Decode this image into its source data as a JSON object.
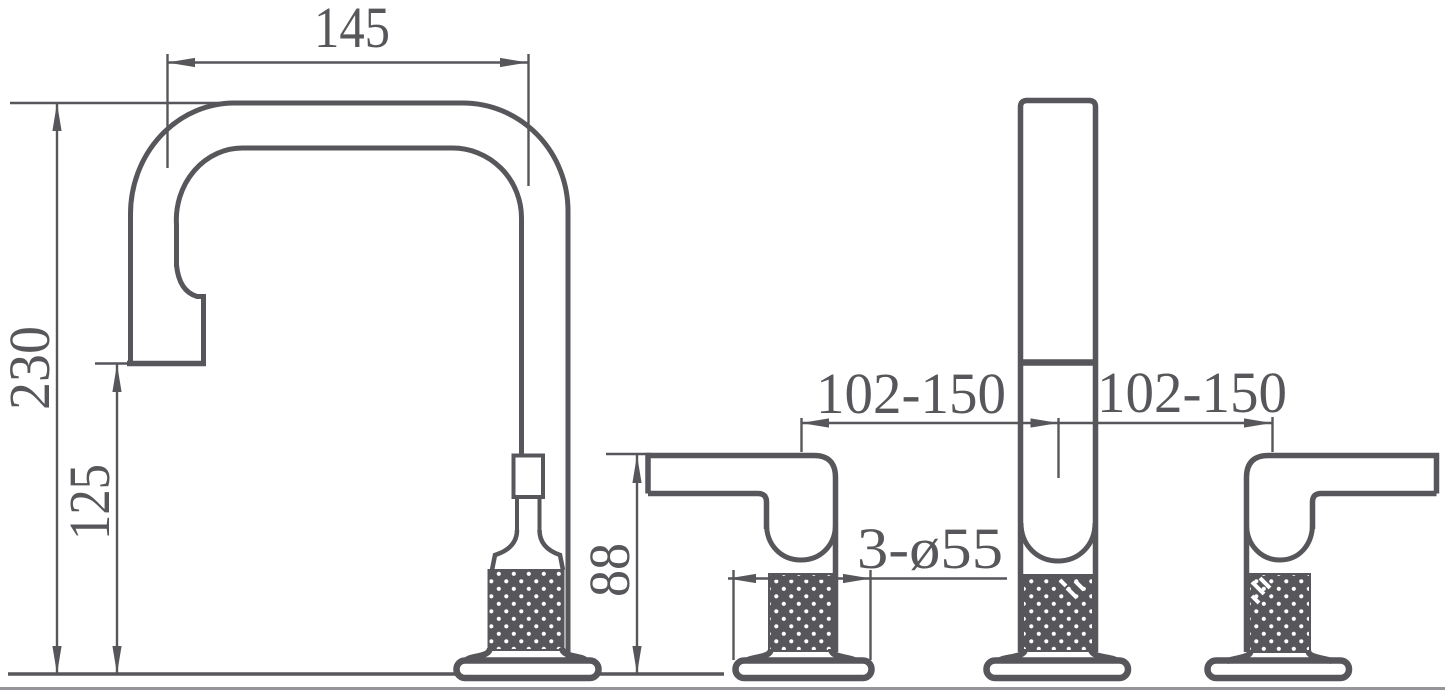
{
  "drawing": {
    "type": "faucet-technical-dimension-drawing",
    "ink_color": "#57575b",
    "border_color": "#95959a",
    "dimensions": {
      "spout_reach": "145",
      "spout_height": "230",
      "outlet_height": "125",
      "handle_height": "88",
      "left_hole_spacing": "102-150",
      "right_hole_spacing": "102-150",
      "hole_diameter": "3-ø55"
    }
  }
}
